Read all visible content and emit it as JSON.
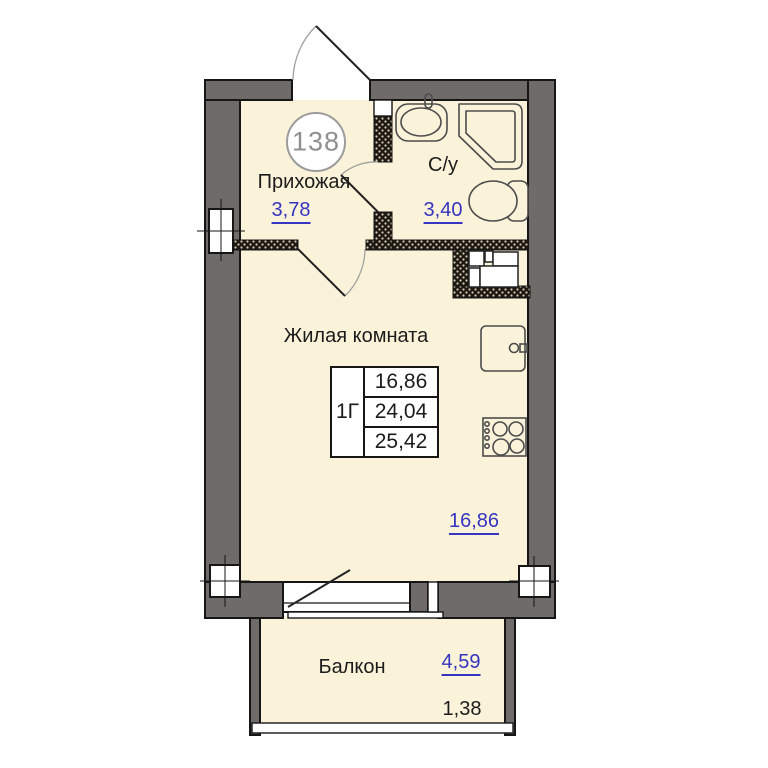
{
  "plan": {
    "apartment_number": "138",
    "rooms": {
      "hallway": {
        "name": "Прихожая",
        "area": "3,78"
      },
      "bathroom": {
        "name": "С/у",
        "area": "3,40"
      },
      "living_room": {
        "name": "Жилая комната",
        "area": "16,86"
      },
      "balcony": {
        "name": "Балкон",
        "area": "4,59",
        "area_reduced": "1,38"
      }
    },
    "info_table": {
      "type": "1Г",
      "rows": [
        "16,86",
        "24,04",
        "25,42"
      ]
    },
    "colors": {
      "floor": "#faf3d9",
      "wall": "#6f6b68",
      "area_value_blue": "#3535c0",
      "hatch_base": "#1d1812"
    }
  }
}
